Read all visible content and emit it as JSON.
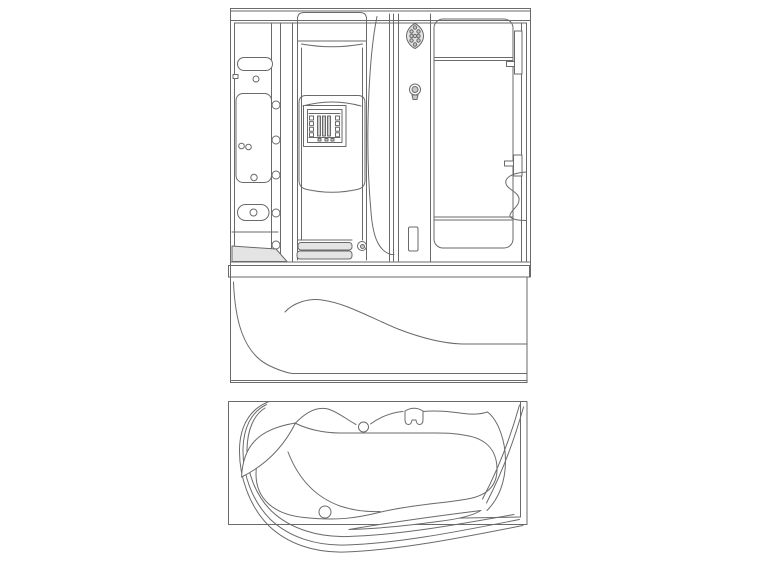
{
  "page": {
    "background_color": "#ffffff",
    "line_color": "#6a6a6a",
    "shade_color": "#c9c9c9",
    "light_shade_color": "#e4e4e4"
  },
  "drawing": {
    "type": "cad-line-drawing",
    "subject": "steam-shower-cabin-with-whirlpool-bathtub",
    "views": [
      {
        "id": "front-elevation",
        "position": "top"
      },
      {
        "id": "plan-view",
        "position": "bottom"
      }
    ]
  }
}
